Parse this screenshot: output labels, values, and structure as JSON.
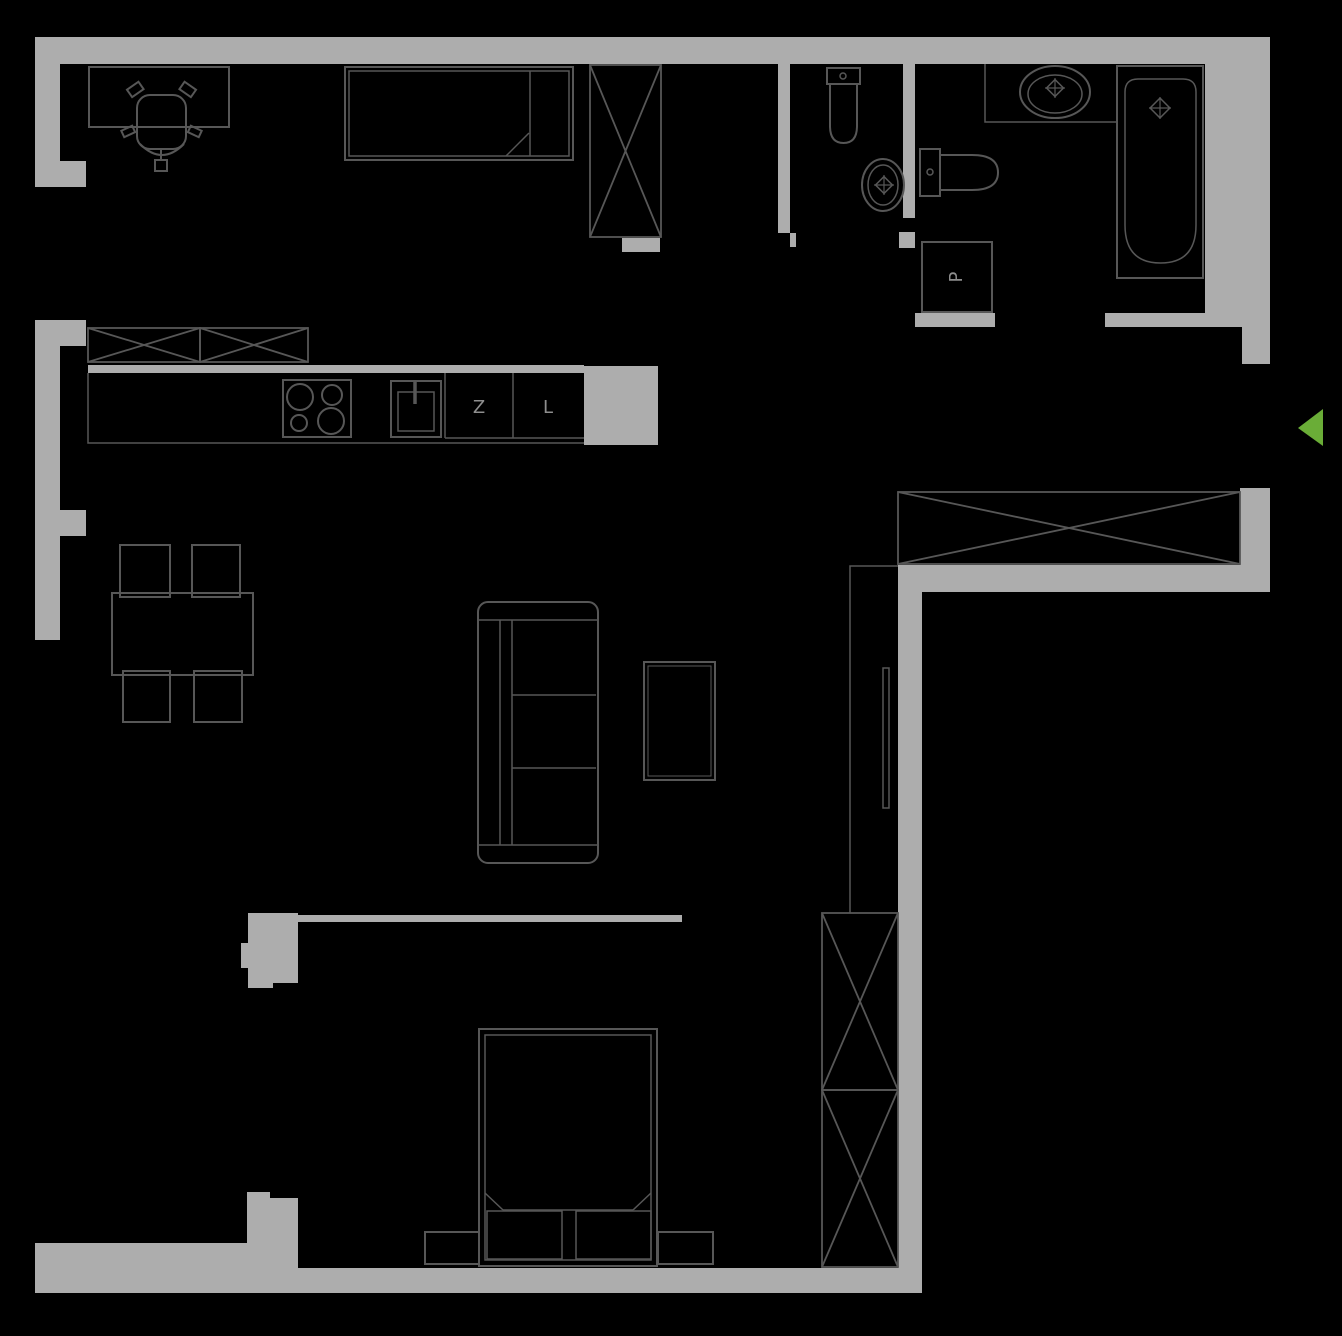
{
  "canvas": {
    "width": 1342,
    "height": 1336,
    "background": "#000000"
  },
  "colors": {
    "wall": "#ADADAD",
    "line": "#575757",
    "thin_line": "#5E5E5E",
    "label": "#8E8E8E",
    "accent_green": "#6AAD37"
  },
  "labels": [
    {
      "n": "kitchen-dishwasher-label",
      "text": "Z",
      "x": 479,
      "y": 413,
      "size": 18,
      "rotate": 0
    },
    {
      "n": "kitchen-fridge-label",
      "text": "L",
      "x": 548,
      "y": 413,
      "size": 18,
      "rotate": 0
    },
    {
      "n": "washing-machine-label",
      "text": "P",
      "x": 956,
      "y": 283,
      "size": 18,
      "rotate": -90,
      "cx": 956,
      "cy": 277
    }
  ],
  "entrance": {
    "n": "entrance-arrow",
    "points": "1298,428 1323,409 1323,446"
  },
  "walls": [
    {
      "n": "wall-top",
      "x": 35,
      "y": 37,
      "w": 1235,
      "h": 27
    },
    {
      "n": "wall-left-upper",
      "x": 35,
      "y": 37,
      "w": 25,
      "h": 150
    },
    {
      "n": "wall-left-upper-notch",
      "x": 60,
      "y": 161,
      "w": 26,
      "h": 26
    },
    {
      "n": "wall-left-kitchen",
      "x": 35,
      "y": 320,
      "w": 25,
      "h": 320
    },
    {
      "n": "wall-left-kitchen-notch-top",
      "x": 60,
      "y": 320,
      "w": 26,
      "h": 26
    },
    {
      "n": "wall-left-kitchen-notch-bottom",
      "x": 60,
      "y": 510,
      "w": 26,
      "h": 26
    },
    {
      "n": "wall-childroom-wc",
      "x": 778,
      "y": 64,
      "w": 12,
      "h": 169
    },
    {
      "n": "wall-childroom-wc-jamb",
      "x": 790,
      "y": 233,
      "w": 6,
      "h": 14
    },
    {
      "n": "wall-wc-bathroom",
      "x": 903,
      "y": 64,
      "w": 12,
      "h": 154
    },
    {
      "n": "wall-wc-jamb",
      "x": 899,
      "y": 232,
      "w": 16,
      "h": 16
    },
    {
      "n": "wall-below-laundry",
      "x": 915,
      "y": 313,
      "w": 80,
      "h": 14
    },
    {
      "n": "wall-bathroom-bottom",
      "x": 1105,
      "y": 313,
      "w": 100,
      "h": 14
    },
    {
      "n": "wall-right-bathroom",
      "x": 1205,
      "y": 64,
      "w": 65,
      "h": 263
    },
    {
      "n": "wall-right-above-entrance",
      "x": 1242,
      "y": 327,
      "w": 28,
      "h": 37
    },
    {
      "n": "wall-right-below-entrance",
      "x": 1240,
      "y": 488,
      "w": 30,
      "h": 77
    },
    {
      "n": "wall-hallway-bottom",
      "x": 898,
      "y": 565,
      "w": 372,
      "h": 27
    },
    {
      "n": "wall-corridor-bedroom",
      "x": 898,
      "y": 565,
      "w": 24,
      "h": 728
    },
    {
      "n": "wall-kitchen-top",
      "x": 88,
      "y": 365,
      "w": 496,
      "h": 8
    },
    {
      "n": "wall-kitchen-block",
      "x": 584,
      "y": 366,
      "w": 74,
      "h": 79
    },
    {
      "n": "wall-bedroom-top",
      "x": 298,
      "y": 915,
      "w": 384,
      "h": 7
    },
    {
      "n": "wall-bedroom-left",
      "x": 248,
      "y": 913,
      "w": 50,
      "h": 70
    },
    {
      "n": "wall-bedroom-left-tab",
      "x": 241,
      "y": 943,
      "w": 7,
      "h": 25
    },
    {
      "n": "wall-bedroom-left-foot",
      "x": 248,
      "y": 967,
      "w": 25,
      "h": 21
    },
    {
      "n": "wall-bottom-left",
      "x": 35,
      "y": 1243,
      "w": 212,
      "h": 50
    },
    {
      "n": "wall-bottom-pillar-a",
      "x": 247,
      "y": 1192,
      "w": 23,
      "h": 101
    },
    {
      "n": "wall-bottom-pillar-b",
      "x": 270,
      "y": 1198,
      "w": 28,
      "h": 95
    },
    {
      "n": "wall-bottom-right",
      "x": 298,
      "y": 1268,
      "w": 624,
      "h": 25
    },
    {
      "n": "wall-childroom-door-stub",
      "x": 622,
      "y": 238,
      "w": 38,
      "h": 14
    }
  ],
  "items": [
    {
      "n": "desk",
      "t": "rect",
      "x": 89,
      "y": 67,
      "w": 140,
      "h": 60
    },
    {
      "n": "office-chair-seat",
      "t": "rect",
      "x": 137,
      "y": 95,
      "w": 49,
      "h": 54,
      "rx": 13
    },
    {
      "n": "office-chair-arm-left",
      "t": "rect",
      "x": 128,
      "y": 85,
      "w": 14,
      "h": 9,
      "tr": "rotate(-35 135 89)"
    },
    {
      "n": "office-chair-arm-right",
      "t": "rect",
      "x": 181,
      "y": 85,
      "w": 14,
      "h": 9,
      "tr": "rotate(35 188 89)"
    },
    {
      "n": "office-chair-side-left",
      "t": "rect",
      "x": 122,
      "y": 128,
      "w": 12,
      "h": 7,
      "tr": "rotate(-25 128 131)"
    },
    {
      "n": "office-chair-side-right",
      "t": "rect",
      "x": 189,
      "y": 128,
      "w": 12,
      "h": 7,
      "tr": "rotate(25 195 131)"
    },
    {
      "n": "office-chair-base",
      "t": "path",
      "d": "M140,144 Q162,166 184,144",
      "s": 2
    },
    {
      "n": "office-chair-stem",
      "t": "line",
      "x1": 161,
      "y1": 150,
      "x2": 161,
      "y2": 161
    },
    {
      "n": "office-chair-foot",
      "t": "rect",
      "x": 155,
      "y": 160,
      "w": 12,
      "h": 11
    },
    {
      "n": "single-bed-outer",
      "t": "rect",
      "x": 345,
      "y": 67,
      "w": 228,
      "h": 93
    },
    {
      "n": "single-bed-inner",
      "t": "rect",
      "x": 349,
      "y": 71,
      "w": 220,
      "h": 85,
      "s": 1.5
    },
    {
      "n": "single-bed-pillow-divider",
      "t": "line",
      "x1": 530,
      "y1": 71,
      "x2": 530,
      "y2": 156,
      "s": 1.5
    },
    {
      "n": "single-bed-blanket-fold",
      "t": "line",
      "x1": 506,
      "y1": 156,
      "x2": 529,
      "y2": 133,
      "s": 1.5
    },
    {
      "n": "childroom-wardrobe",
      "t": "xbox",
      "x": 590,
      "y": 65,
      "w": 71,
      "h": 172
    },
    {
      "n": "kitchen-cabinet-left",
      "t": "xbox",
      "x": 88,
      "y": 328,
      "w": 112,
      "h": 34
    },
    {
      "n": "kitchen-cabinet-right",
      "t": "xbox",
      "x": 200,
      "y": 328,
      "w": 108,
      "h": 34
    },
    {
      "n": "kitchen-counter-edge",
      "t": "path",
      "d": "M88,373 L88,443 L584,443",
      "s": 1.5
    },
    {
      "n": "stove",
      "t": "rect",
      "x": 283,
      "y": 380,
      "w": 68,
      "h": 57
    },
    {
      "n": "stove-burner-1",
      "t": "circle",
      "cx": 300,
      "cy": 397,
      "r": 13
    },
    {
      "n": "stove-burner-2",
      "t": "circle",
      "cx": 332,
      "cy": 395,
      "r": 10
    },
    {
      "n": "stove-burner-3",
      "t": "circle",
      "cx": 299,
      "cy": 423,
      "r": 8
    },
    {
      "n": "stove-burner-4",
      "t": "circle",
      "cx": 331,
      "cy": 421,
      "r": 13
    },
    {
      "n": "kitchen-sink-outer",
      "t": "rect",
      "x": 391,
      "y": 381,
      "w": 50,
      "h": 56
    },
    {
      "n": "kitchen-sink-inner",
      "t": "rect",
      "x": 398,
      "y": 392,
      "w": 36,
      "h": 39,
      "s": 1.5
    },
    {
      "n": "kitchen-sink-faucet",
      "t": "line",
      "x1": 415,
      "y1": 381,
      "x2": 415,
      "y2": 404,
      "s": 3.5
    },
    {
      "n": "kitchen-cell-line-1",
      "t": "line",
      "x1": 445,
      "y1": 373,
      "x2": 445,
      "y2": 438,
      "s": 1.5
    },
    {
      "n": "kitchen-cell-line-2",
      "t": "line",
      "x1": 513,
      "y1": 373,
      "x2": 513,
      "y2": 438,
      "s": 1.5
    },
    {
      "n": "kitchen-cell-bottom",
      "t": "line",
      "x1": 445,
      "y1": 438,
      "x2": 584,
      "y2": 438,
      "s": 1.5
    },
    {
      "n": "dining-table",
      "t": "rect",
      "x": 112,
      "y": 593,
      "w": 141,
      "h": 82
    },
    {
      "n": "dining-chair-1",
      "t": "rect",
      "x": 120,
      "y": 545,
      "w": 50,
      "h": 52
    },
    {
      "n": "dining-chair-2",
      "t": "rect",
      "x": 192,
      "y": 545,
      "w": 48,
      "h": 52
    },
    {
      "n": "dining-chair-3",
      "t": "rect",
      "x": 123,
      "y": 671,
      "w": 47,
      "h": 51
    },
    {
      "n": "dining-chair-4",
      "t": "rect",
      "x": 194,
      "y": 671,
      "w": 48,
      "h": 51
    },
    {
      "n": "sofa-outline",
      "t": "rect",
      "x": 478,
      "y": 602,
      "w": 120,
      "h": 261,
      "rx": 10
    },
    {
      "n": "sofa-armrest-top",
      "t": "line",
      "x1": 478,
      "y1": 620,
      "x2": 598,
      "y2": 620,
      "s": 1.5
    },
    {
      "n": "sofa-armrest-bottom",
      "t": "line",
      "x1": 478,
      "y1": 845,
      "x2": 598,
      "y2": 845,
      "s": 1.5
    },
    {
      "n": "sofa-backrest-line-1",
      "t": "line",
      "x1": 500,
      "y1": 620,
      "x2": 500,
      "y2": 845,
      "s": 1.5
    },
    {
      "n": "sofa-backrest-line-2",
      "t": "line",
      "x1": 512,
      "y1": 620,
      "x2": 512,
      "y2": 845,
      "s": 1.5
    },
    {
      "n": "sofa-seat-divider-1",
      "t": "line",
      "x1": 512,
      "y1": 695,
      "x2": 596,
      "y2": 695,
      "s": 1.5
    },
    {
      "n": "sofa-seat-divider-2",
      "t": "line",
      "x1": 512,
      "y1": 768,
      "x2": 596,
      "y2": 768,
      "s": 1.5
    },
    {
      "n": "coffee-table-outer",
      "t": "rect",
      "x": 644,
      "y": 662,
      "w": 71,
      "h": 118
    },
    {
      "n": "coffee-table-inner",
      "t": "rect",
      "x": 648,
      "y": 666,
      "w": 63,
      "h": 110,
      "s": 1
    },
    {
      "n": "hallway-wardrobe",
      "t": "xbox",
      "x": 898,
      "y": 492,
      "w": 342,
      "h": 72
    },
    {
      "n": "sliding-door-track",
      "t": "path",
      "d": "M850,913 L850,566 L898,566",
      "s": 1.5
    },
    {
      "n": "sliding-door-panel",
      "t": "rect",
      "x": 883,
      "y": 668,
      "w": 6,
      "h": 140,
      "s": 1.5
    },
    {
      "n": "double-bed-outer",
      "t": "rect",
      "x": 479,
      "y": 1029,
      "w": 178,
      "h": 237
    },
    {
      "n": "double-bed-inner",
      "t": "rect",
      "x": 485,
      "y": 1035,
      "w": 166,
      "h": 225,
      "s": 1.5
    },
    {
      "n": "double-bed-blanket-edge",
      "t": "line",
      "x1": 503,
      "y1": 1210,
      "x2": 633,
      "y2": 1210,
      "s": 1.5
    },
    {
      "n": "double-bed-fold-left",
      "t": "line",
      "x1": 485,
      "y1": 1193,
      "x2": 503,
      "y2": 1210,
      "s": 1.5
    },
    {
      "n": "double-bed-fold-right",
      "t": "line",
      "x1": 651,
      "y1": 1193,
      "x2": 633,
      "y2": 1210,
      "s": 1.5
    },
    {
      "n": "double-bed-pillow-left",
      "t": "rect",
      "x": 487,
      "y": 1211,
      "w": 75,
      "h": 48,
      "s": 1.5
    },
    {
      "n": "double-bed-pillow-right",
      "t": "rect",
      "x": 576,
      "y": 1211,
      "w": 75,
      "h": 48,
      "s": 1.5
    },
    {
      "n": "nightstand-left",
      "t": "rect",
      "x": 425,
      "y": 1232,
      "w": 54,
      "h": 32
    },
    {
      "n": "nightstand-right",
      "t": "rect",
      "x": 658,
      "y": 1232,
      "w": 55,
      "h": 32
    },
    {
      "n": "bedroom-wardrobe-top",
      "t": "xbox",
      "x": 822,
      "y": 913,
      "w": 76,
      "h": 177
    },
    {
      "n": "bedroom-wardrobe-bottom",
      "t": "xbox",
      "x": 822,
      "y": 1090,
      "w": 76,
      "h": 177
    },
    {
      "n": "wc-toilet-tank",
      "t": "rect",
      "x": 827,
      "y": 68,
      "w": 33,
      "h": 16
    },
    {
      "n": "wc-toilet-bowl",
      "t": "path",
      "d": "M830,84 L857,84 L857,126 Q857,143 843.5,143 Q830,143 830,126 Z"
    },
    {
      "n": "wc-toilet-button",
      "t": "circle",
      "cx": 843,
      "cy": 76,
      "r": 3,
      "s": 1.5
    },
    {
      "n": "wc-sink-outer",
      "t": "ellipse",
      "cx": 883,
      "cy": 185,
      "rx": 21,
      "ry": 26
    },
    {
      "n": "wc-sink-inner",
      "t": "ellipse",
      "cx": 883,
      "cy": 185,
      "rx": 15,
      "ry": 20,
      "s": 1.5
    },
    {
      "n": "wc-sink-faucet",
      "t": "diamond",
      "cx": 884,
      "cy": 185,
      "r": 6
    },
    {
      "n": "laundry-box",
      "t": "rect",
      "x": 922,
      "y": 242,
      "w": 70,
      "h": 70
    },
    {
      "n": "bathroom-toilet-tank",
      "t": "rect",
      "x": 920,
      "y": 149,
      "w": 20,
      "h": 47
    },
    {
      "n": "bathroom-toilet-bowl",
      "t": "path",
      "d": "M940,155 L972,155 Q998,155 998,172.5 Q998,190 972,190 L940,190 Z"
    },
    {
      "n": "bathroom-toilet-button",
      "t": "circle",
      "cx": 930,
      "cy": 172,
      "r": 3,
      "s": 1.5
    },
    {
      "n": "bathroom-counter",
      "t": "path",
      "d": "M985,64 L985,122 L1117,122",
      "s": 1.5
    },
    {
      "n": "bathroom-sink-outer",
      "t": "ellipse",
      "cx": 1055,
      "cy": 92,
      "rx": 35,
      "ry": 26
    },
    {
      "n": "bathroom-sink-inner",
      "t": "ellipse",
      "cx": 1055,
      "cy": 94,
      "rx": 27,
      "ry": 19,
      "s": 1.5
    },
    {
      "n": "bathroom-sink-faucet",
      "t": "diamond",
      "cx": 1055,
      "cy": 88,
      "r": 6
    },
    {
      "n": "bathtub-outer",
      "t": "rect",
      "x": 1117,
      "y": 66,
      "w": 86,
      "h": 212
    },
    {
      "n": "bathtub-inner",
      "t": "path",
      "d": "M1125,92 Q1125,79 1138,79 L1183,79 Q1196,79 1196,92 L1196,225 Q1196,263 1160.5,263 Q1125,263 1125,225 Z",
      "s": 1.5
    },
    {
      "n": "bathtub-faucet",
      "t": "diamond",
      "cx": 1160,
      "cy": 108,
      "r": 7
    }
  ]
}
